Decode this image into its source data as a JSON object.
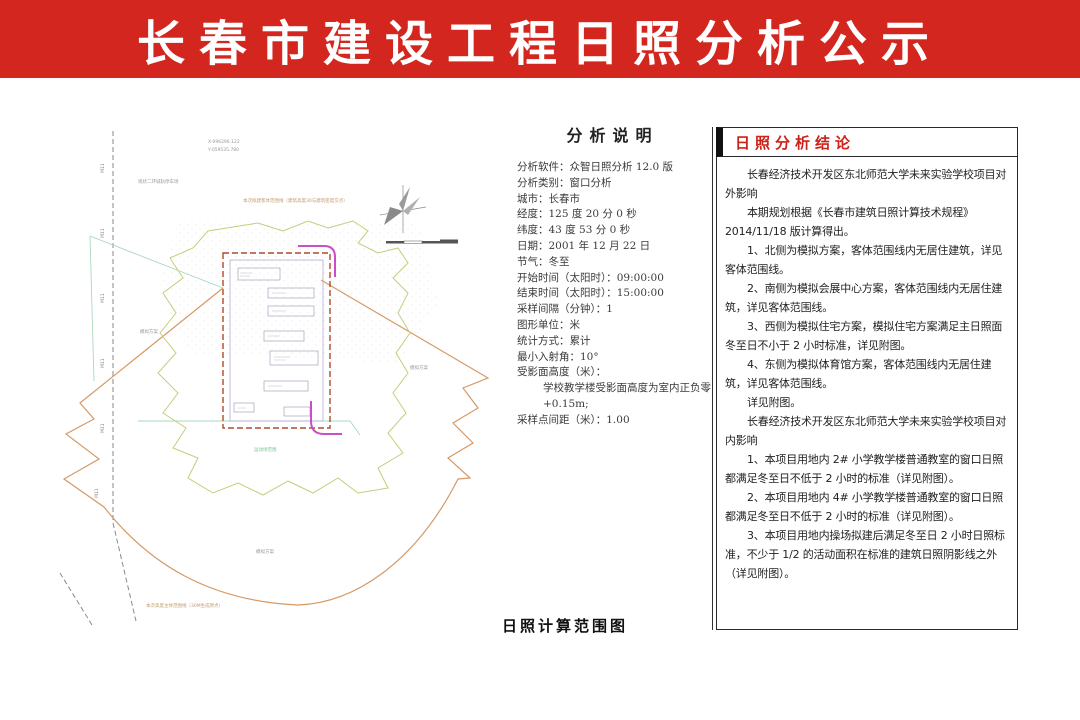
{
  "header": {
    "title": "长春市建设工程日照分析公示",
    "bg_color": "#d3261e",
    "text_color": "#ffffff"
  },
  "map": {
    "caption": "日照计算范围图",
    "labels": {
      "coord_x": "X-096296.122",
      "coord_y": "Y-059535.780",
      "existing_note": "现状二环城轨停车场",
      "object_scope_note": "本次拟建客体范围线（建筑高度30与建筑密度交点）",
      "sim_left": "模拟方案",
      "sim_right": "模拟方案",
      "sim_bottom": "模拟方案",
      "playground_note": "运动场范围",
      "subject_scope_note": "本次高度主体范围线（30M生成原点）",
      "road_label": "M11"
    },
    "colors": {
      "fan_outline": "#d59a66",
      "site_boundary_dash": "#b04a2c",
      "scope_line": "#c3ce7a",
      "magenta_line": "#c94fc9",
      "green_line": "#a8d8bc",
      "gray_dash": "#8a8a8a"
    }
  },
  "analysis": {
    "title": "分析说明",
    "items": [
      {
        "text": "分析软件：众智日照分析 12.0 版",
        "indent": false
      },
      {
        "text": "分析类别：窗口分析",
        "indent": false
      },
      {
        "text": "城市：长春市",
        "indent": false
      },
      {
        "text": "经度：125 度 20 分 0 秒",
        "indent": false
      },
      {
        "text": "纬度：43 度 53 分 0 秒",
        "indent": false
      },
      {
        "text": "日期：2001 年 12 月 22 日",
        "indent": false
      },
      {
        "text": "节气：冬至",
        "indent": false
      },
      {
        "text": "开始时间（太阳时）：09:00:00",
        "indent": false
      },
      {
        "text": "结束时间（太阳时）：15:00:00",
        "indent": false
      },
      {
        "text": "采样间隔（分钟）：1",
        "indent": false
      },
      {
        "text": "图形单位：米",
        "indent": false
      },
      {
        "text": "统计方式：累计",
        "indent": false
      },
      {
        "text": "最小入射角：10°",
        "indent": false
      },
      {
        "text": "受影面高度（米）：",
        "indent": false
      },
      {
        "text": "学校教学楼受影面高度为室内正负零 +0.15m;",
        "indent": true
      },
      {
        "text": "采样点间距（米）：1.00",
        "indent": false
      }
    ]
  },
  "conclusion": {
    "title": "日照分析结论",
    "title_color": "#cc2218",
    "paragraphs": [
      "长春经济技术开发区东北师范大学未来实验学校项目对外影响",
      "本期规划根据《长春市建筑日照计算技术规程》2014/11/18 版计算得出。",
      "1、北侧为模拟方案，客体范围线内无居住建筑，详见客体范围线。",
      "2、南侧为模拟会展中心方案，客体范围线内无居住建筑，详见客体范围线。",
      "3、西侧为模拟住宅方案，模拟住宅方案满足主日照面冬至日不小于 2 小时标准，详见附图。",
      "4、东侧为模拟体育馆方案，客体范围线内无居住建筑，详见客体范围线。",
      "详见附图。",
      "长春经济技术开发区东北师范大学未来实验学校项目对内影响",
      "1、本项目用地内 2# 小学教学楼普通教室的窗口日照都满足冬至日不低于 2 小时的标准（详见附图）。",
      "2、本项目用地内 4# 小学教学楼普通教室的窗口日照都满足冬至日不低于 2 小时的标准（详见附图）。",
      "3、本项目用地内操场拟建后满足冬至日 2 小时日照标准，不少于 1/2 的活动面积在标准的建筑日照阴影线之外（详见附图）。"
    ]
  }
}
